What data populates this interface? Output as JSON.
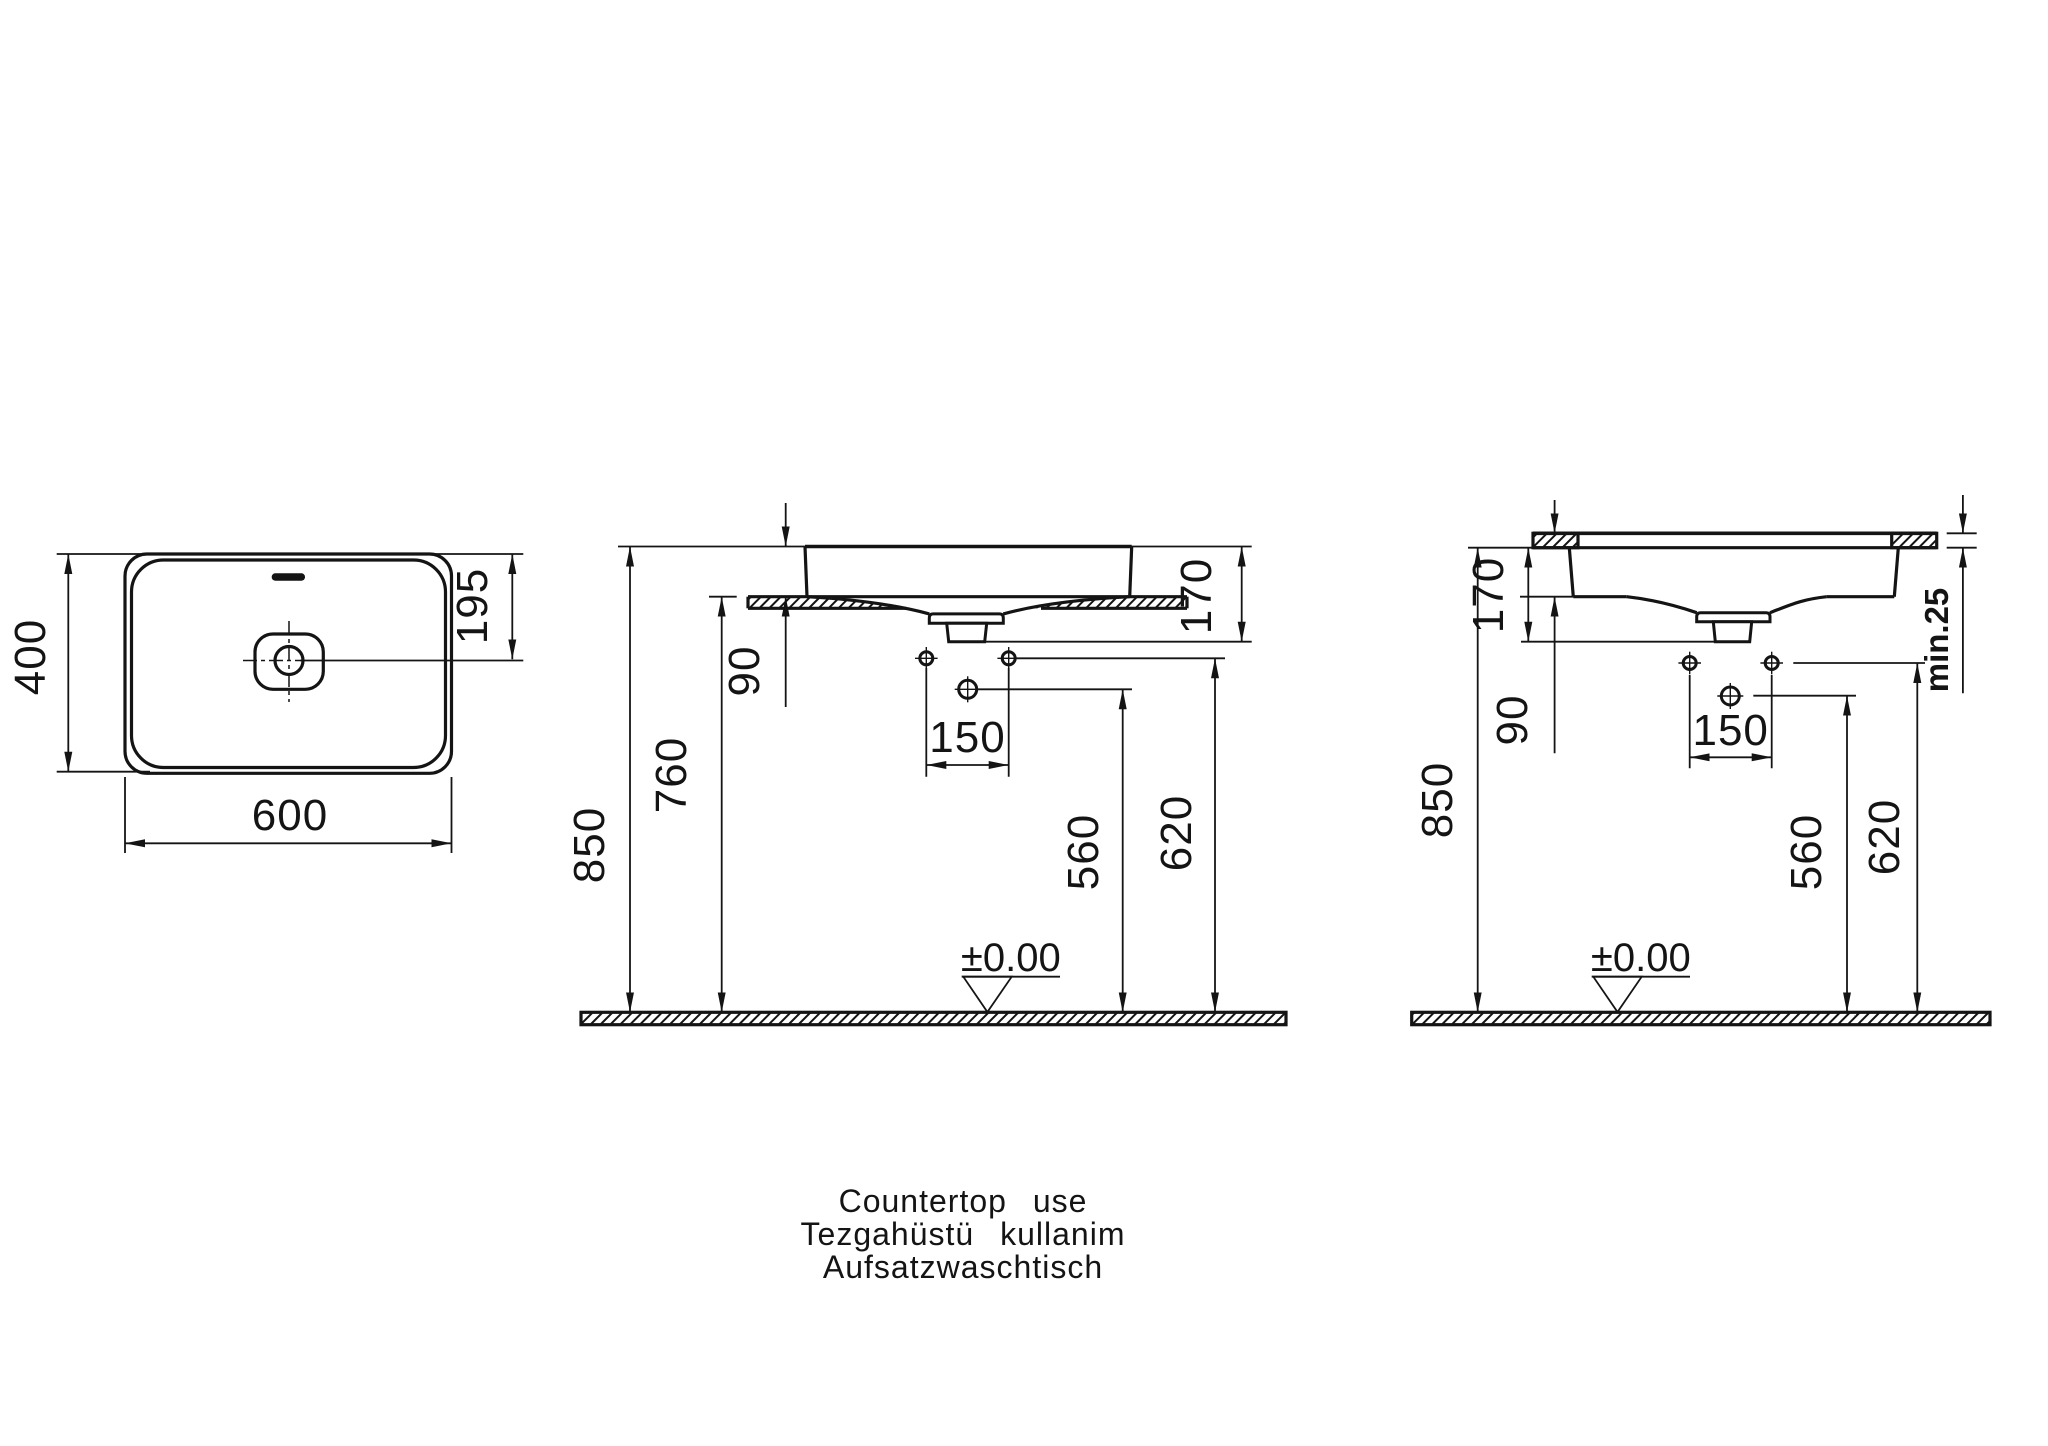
{
  "page": {
    "background": "#ffffff",
    "line_color": "#141414",
    "kind": "sanitary-ware installation drawing"
  },
  "top_view": {
    "width": "600",
    "depth": "400",
    "drain_center_from_rear": "195"
  },
  "countertop_view": {
    "rim_height": "850",
    "counter_height": "760",
    "rim_above_counter": "90",
    "basin_depth": "170",
    "hole_spacing": "150",
    "trap_connection_height": "560",
    "supply_height": "620",
    "floor_datum": "±0.00"
  },
  "recessed_view": {
    "rim_height": "850",
    "basin_depth": "170",
    "rim_above_counter": "90",
    "hole_spacing": "150",
    "trap_connection_height": "560",
    "supply_height": "620",
    "floor_datum": "±0.00",
    "min_counter_thickness": "min.25"
  },
  "caption": {
    "line1": "Countertop use",
    "line2": "Tezgahüstü kullanim",
    "line3": "Aufsatzwaschtisch"
  }
}
